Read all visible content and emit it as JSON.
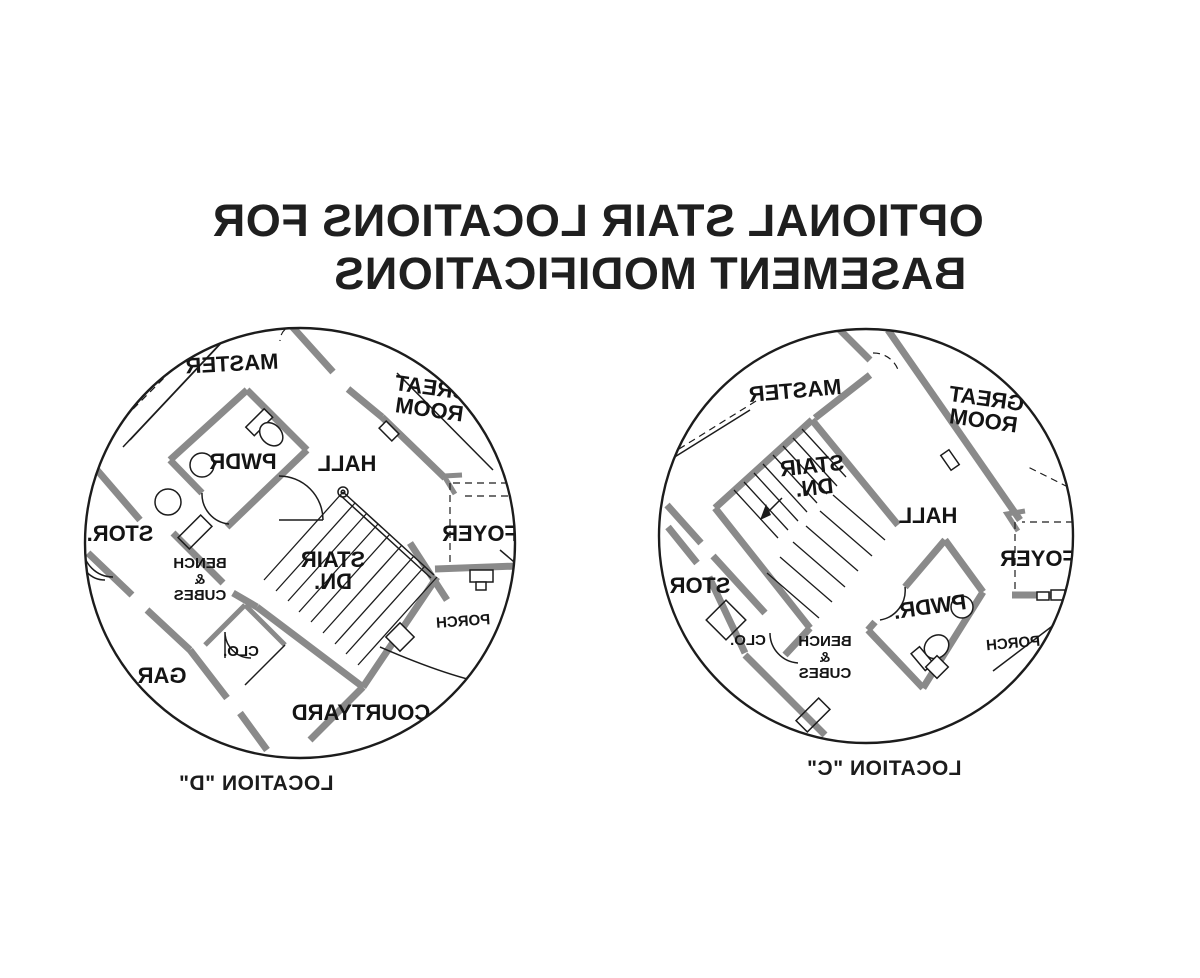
{
  "title": {
    "line1": "OPTIONAL STAIR LOCATIONS FOR",
    "line2": "BASEMENT MODIFICATIONS"
  },
  "diagrams": {
    "d": {
      "caption": "LOCATION \"D\"",
      "rooms": {
        "master": "MASTER",
        "great_1": "GREAT",
        "great_2": "ROOM",
        "hall": "HALL",
        "pwdr": "PWDR",
        "stor": "STOR.",
        "bench_1": "BENCH",
        "bench_2": "&",
        "bench_3": "CUBES",
        "stair_1": "STAIR",
        "stair_2": "DN.",
        "clo": "CLO.",
        "gar": "GAR.",
        "courtyard": "COURTYARD",
        "porch": "PORCH",
        "foyer": "FOYER"
      }
    },
    "c": {
      "caption": "LOCATION \"C\"",
      "rooms": {
        "master": "MASTER",
        "great_1": "GREAT",
        "great_2": "ROOM",
        "stair_1": "STAIR",
        "stair_2": "DN.",
        "hall": "HALL",
        "foyer": "FOYER",
        "stor": "STOR",
        "clo": "CLO.",
        "bench_1": "BENCH",
        "bench_2": "&",
        "bench_3": "CUBES",
        "pwdr": "PWDR.",
        "porch": "PORCH"
      }
    }
  },
  "colors": {
    "background": "#ffffff",
    "line": "#1c1c1c",
    "wall_fill": "#8a8a8a"
  }
}
